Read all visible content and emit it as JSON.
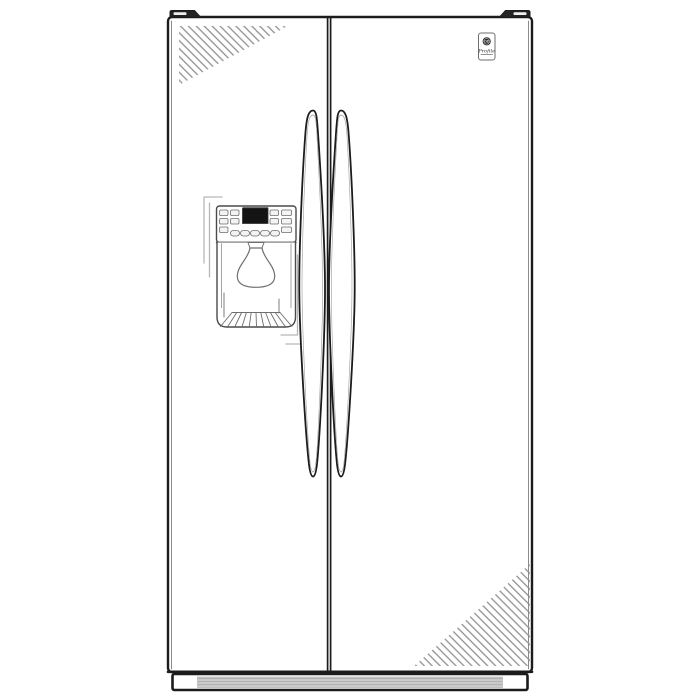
{
  "image": {
    "description": "Line-art illustration of a side-by-side refrigerator with through-the-door ice and water dispenser",
    "badge": {
      "brand_monogram": "GE",
      "series": "Profile"
    },
    "colors": {
      "background": "#ffffff",
      "outline": "#1c1c1c",
      "panel-line": "#4a4a4a",
      "soft-line": "#6e6e6e",
      "echo-line": "#b6b6b6",
      "hatch-line": "#8c8c8c",
      "lcd-fill": "#141414",
      "grille-fill": "#cbcbcb",
      "grille-stripe": "#aeaeae",
      "button-fill": "#f3f3f3",
      "hinge-fill": "#242424"
    }
  }
}
